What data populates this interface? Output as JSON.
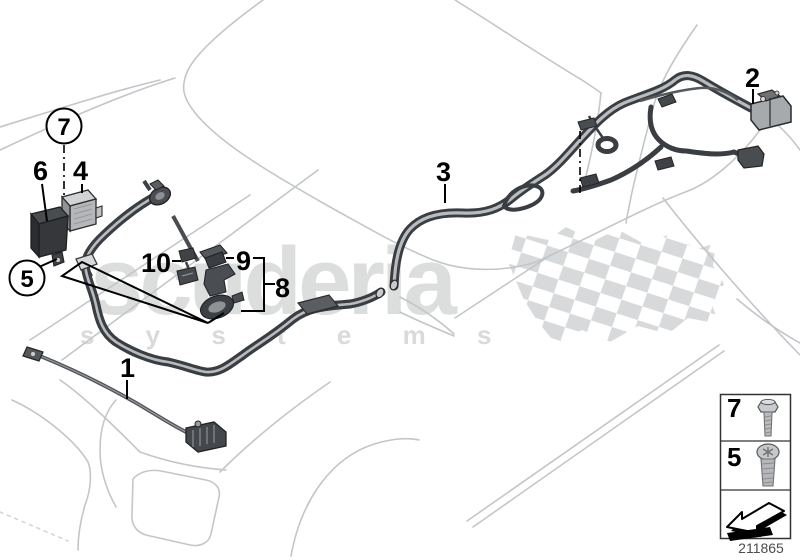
{
  "watermark": {
    "brand": "scuderia",
    "subtitle": "s y s t e m s"
  },
  "callouts": {
    "n1": "1",
    "n2": "2",
    "n3": "3",
    "n4": "4",
    "n5": "5",
    "n6": "6",
    "n7": "7",
    "n8": "8",
    "n9": "9",
    "n10": "10"
  },
  "legend": {
    "rows": [
      {
        "num": "7",
        "icon": "hex-bolt-icon"
      },
      {
        "num": "5",
        "icon": "pan-head-screw-icon"
      }
    ]
  },
  "footer": {
    "diagram_number": "211865"
  },
  "colors": {
    "cable": "#3a3d41",
    "cable_core": "#b9bcbe",
    "car_outline": "#c3c6c9",
    "watermark": "#d9dadb",
    "label": "#000000"
  }
}
